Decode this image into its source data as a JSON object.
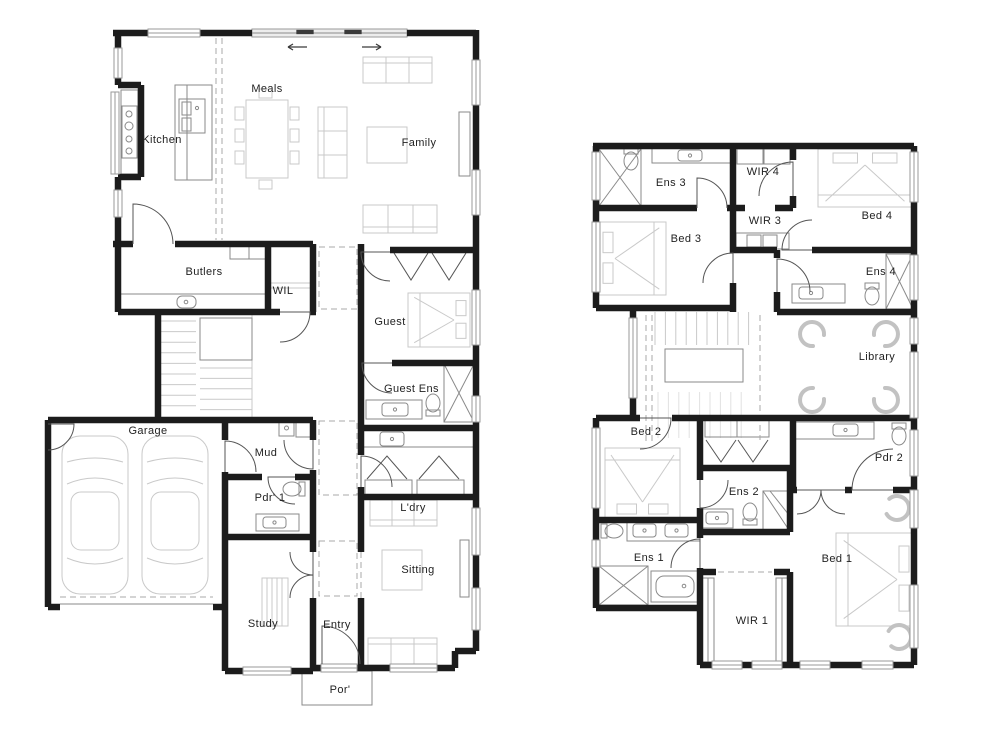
{
  "title": "House floor plans - ground and upper floor",
  "colors": {
    "wall": "#1c1c1c",
    "fixture": "#8a8a8a",
    "furniture": "#c9c9c9",
    "faint": "#e2e2e2",
    "dash": "#a8a8a8",
    "door": "#555555",
    "dark": "#3a3a3a",
    "window": "#9a9a9a",
    "label": "#222222"
  },
  "floors": {
    "ground": {
      "kitchen": "Kitchen",
      "meals": "Meals",
      "family": "Family",
      "butlers": "Butlers",
      "wil": "WIL",
      "guest": "Guest",
      "guest_ens": "Guest Ens",
      "garage": "Garage",
      "mud": "Mud",
      "pdr1": "Pdr' 1",
      "ldry": "L'dry",
      "sitting": "Sitting",
      "study": "Study",
      "entry": "Entry",
      "porch": "Por'"
    },
    "upper": {
      "ens3": "Ens 3",
      "wir4": "WIR 4",
      "bed4": "Bed 4",
      "wir3": "WIR 3",
      "bed3": "Bed 3",
      "ens4": "Ens 4",
      "library": "Library",
      "bed2": "Bed 2",
      "pdr2": "Pdr 2",
      "ens2": "Ens 2",
      "ens1": "Ens 1",
      "bed1": "Bed 1",
      "wir1": "WIR 1"
    }
  }
}
